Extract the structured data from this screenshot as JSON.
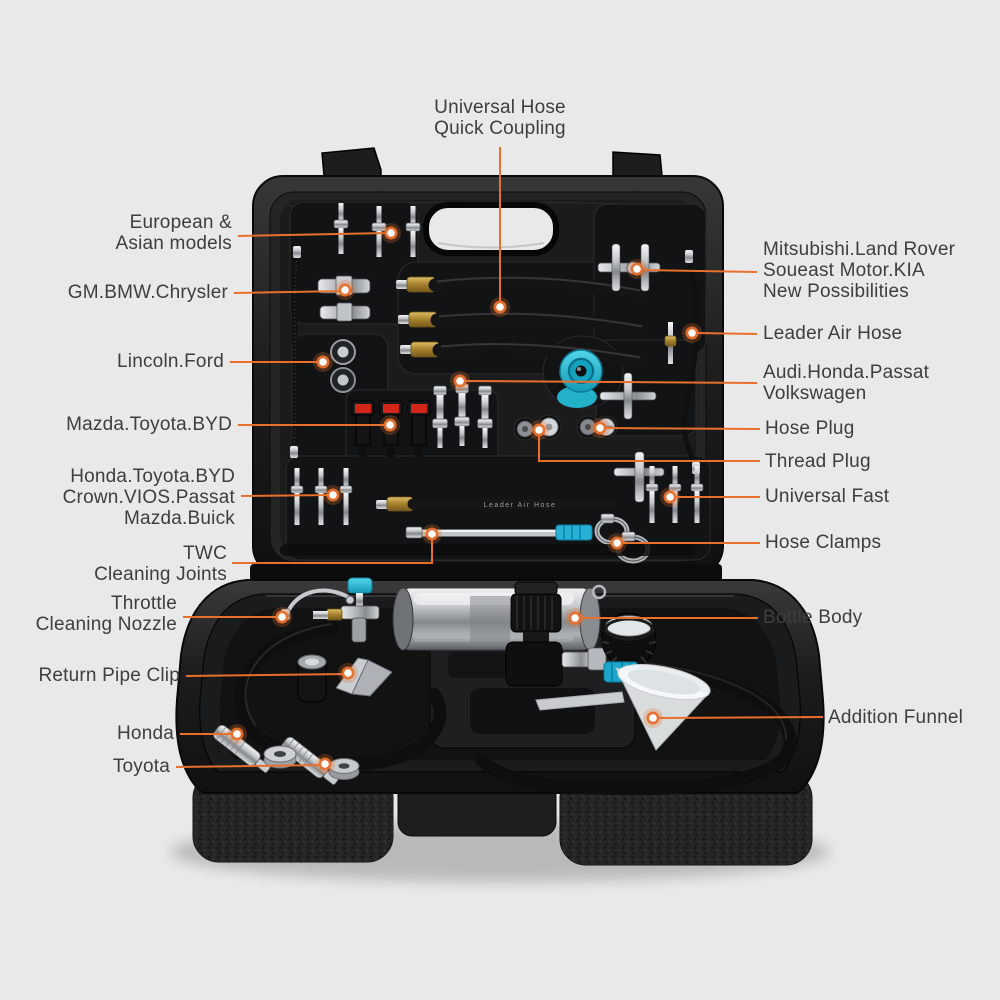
{
  "style": {
    "background": "#e9e9e9",
    "accent_orange": "#e8702c",
    "label_color": "#3e3e3e",
    "case_black": "#1a1a1a",
    "teal": "#33c3da",
    "metal_silver": "#c7cacd",
    "brass_gold": "#b08c34",
    "red_connector": "#d2261b"
  },
  "product": {
    "hose_print": "Leader Air Hose"
  },
  "callouts": [
    {
      "id": "universal-hose-quick-coupling",
      "align": "center",
      "x": 500,
      "y": 97,
      "lines": [
        "Universal Hose",
        "Quick Coupling"
      ],
      "line": [
        [
          500,
          147
        ],
        [
          500,
          307
        ]
      ],
      "dot": [
        500,
        307
      ]
    },
    {
      "id": "european-asian-models",
      "align": "right",
      "x": 232,
      "y": 212,
      "lines": [
        "European &",
        "Asian models"
      ],
      "line": [
        [
          238,
          236
        ],
        [
          391,
          233
        ]
      ],
      "dot": [
        391,
        233
      ]
    },
    {
      "id": "gm-bmw-chrysler",
      "align": "right",
      "x": 228,
      "y": 282,
      "lines": [
        "GM.BMW.Chrysler"
      ],
      "line": [
        [
          234,
          293
        ],
        [
          345,
          291
        ]
      ],
      "dot": [
        345,
        290
      ]
    },
    {
      "id": "lincoln-ford",
      "align": "right",
      "x": 224,
      "y": 351,
      "lines": [
        "Lincoln.Ford"
      ],
      "line": [
        [
          230,
          362
        ],
        [
          323,
          362
        ]
      ],
      "dot": [
        323,
        362
      ]
    },
    {
      "id": "mazda-toyota-byd",
      "align": "right",
      "x": 232,
      "y": 414,
      "lines": [
        "Mazda.Toyota.BYD"
      ],
      "line": [
        [
          238,
          425
        ],
        [
          390,
          425
        ]
      ],
      "dot": [
        390,
        425
      ]
    },
    {
      "id": "honda-toyota-byd-crown-vios-passat-mazda-buick",
      "align": "right",
      "x": 235,
      "y": 466,
      "lines": [
        "Honda.Toyota.BYD",
        "Crown.VIOS.Passat",
        "Mazda.Buick"
      ],
      "line": [
        [
          241,
          496
        ],
        [
          333,
          495
        ]
      ],
      "dot": [
        333,
        495
      ]
    },
    {
      "id": "twc-cleaning-joints",
      "align": "right",
      "x": 227,
      "y": 543,
      "lines": [
        "TWC",
        "Cleaning Joints"
      ],
      "line": [
        [
          232,
          563
        ],
        [
          432,
          563
        ],
        [
          432,
          537
        ]
      ],
      "dot": [
        432,
        534
      ]
    },
    {
      "id": "throttle-cleaning-nozzle",
      "align": "right",
      "x": 177,
      "y": 593,
      "lines": [
        "Throttle",
        "Cleaning Nozzle"
      ],
      "line": [
        [
          183,
          617
        ],
        [
          282,
          617
        ]
      ],
      "dot": [
        282,
        617
      ]
    },
    {
      "id": "return-pipe-clip",
      "align": "right",
      "x": 180,
      "y": 665,
      "lines": [
        "Return Pipe Clip"
      ],
      "line": [
        [
          186,
          676
        ],
        [
          348,
          674
        ]
      ],
      "dot": [
        348,
        673
      ]
    },
    {
      "id": "honda",
      "align": "right",
      "x": 174,
      "y": 723,
      "lines": [
        "Honda"
      ],
      "line": [
        [
          180,
          734
        ],
        [
          237,
          734
        ]
      ],
      "dot": [
        237,
        734
      ]
    },
    {
      "id": "toyota",
      "align": "right",
      "x": 170,
      "y": 756,
      "lines": [
        "Toyota"
      ],
      "line": [
        [
          176,
          767
        ],
        [
          325,
          765
        ]
      ],
      "dot": [
        325,
        764
      ]
    },
    {
      "id": "mitsubishi-landrover-soueast-kia",
      "align": "left",
      "x": 763,
      "y": 239,
      "lines": [
        "Mitsubishi.Land Rover",
        "Soueast Motor.KIA",
        "New Possibilities"
      ],
      "line": [
        [
          757,
          272
        ],
        [
          641,
          270
        ]
      ],
      "dot": [
        637,
        269
      ]
    },
    {
      "id": "leader-air-hose",
      "align": "left",
      "x": 763,
      "y": 323,
      "lines": [
        "Leader Air Hose"
      ],
      "line": [
        [
          757,
          334
        ],
        [
          697,
          333
        ]
      ],
      "dot": [
        692,
        333
      ]
    },
    {
      "id": "audi-honda-passat-volkswagen",
      "align": "left",
      "x": 763,
      "y": 362,
      "lines": [
        "Audi.Honda.Passat",
        "Volkswagen"
      ],
      "line": [
        [
          757,
          383
        ],
        [
          466,
          381
        ]
      ],
      "dot": [
        460,
        381
      ]
    },
    {
      "id": "hose-plug",
      "align": "left",
      "x": 765,
      "y": 418,
      "lines": [
        "Hose Plug"
      ],
      "line": [
        [
          760,
          429
        ],
        [
          606,
          428
        ]
      ],
      "dot": [
        600,
        428
      ]
    },
    {
      "id": "thread-plug",
      "align": "left",
      "x": 765,
      "y": 451,
      "lines": [
        "Thread Plug"
      ],
      "line": [
        [
          760,
          461
        ],
        [
          539,
          461
        ],
        [
          539,
          435
        ]
      ],
      "dot": [
        539,
        430
      ]
    },
    {
      "id": "universal-fast",
      "align": "left",
      "x": 765,
      "y": 486,
      "lines": [
        "Universal Fast"
      ],
      "line": [
        [
          760,
          497
        ],
        [
          676,
          497
        ]
      ],
      "dot": [
        670,
        497
      ]
    },
    {
      "id": "hose-clamps",
      "align": "left",
      "x": 765,
      "y": 532,
      "lines": [
        "Hose Clamps"
      ],
      "line": [
        [
          760,
          543
        ],
        [
          623,
          543
        ]
      ],
      "dot": [
        617,
        543
      ]
    },
    {
      "id": "bottle-body",
      "align": "left",
      "x": 763,
      "y": 607,
      "lines": [
        "Bottle Body"
      ],
      "line": [
        [
          758,
          618
        ],
        [
          581,
          618
        ]
      ],
      "dot": [
        575,
        618
      ]
    },
    {
      "id": "addition-funnel",
      "align": "left",
      "x": 828,
      "y": 707,
      "lines": [
        "Addition Funnel"
      ],
      "line": [
        [
          823,
          717
        ],
        [
          659,
          718
        ]
      ],
      "dot": [
        653,
        718
      ]
    }
  ]
}
